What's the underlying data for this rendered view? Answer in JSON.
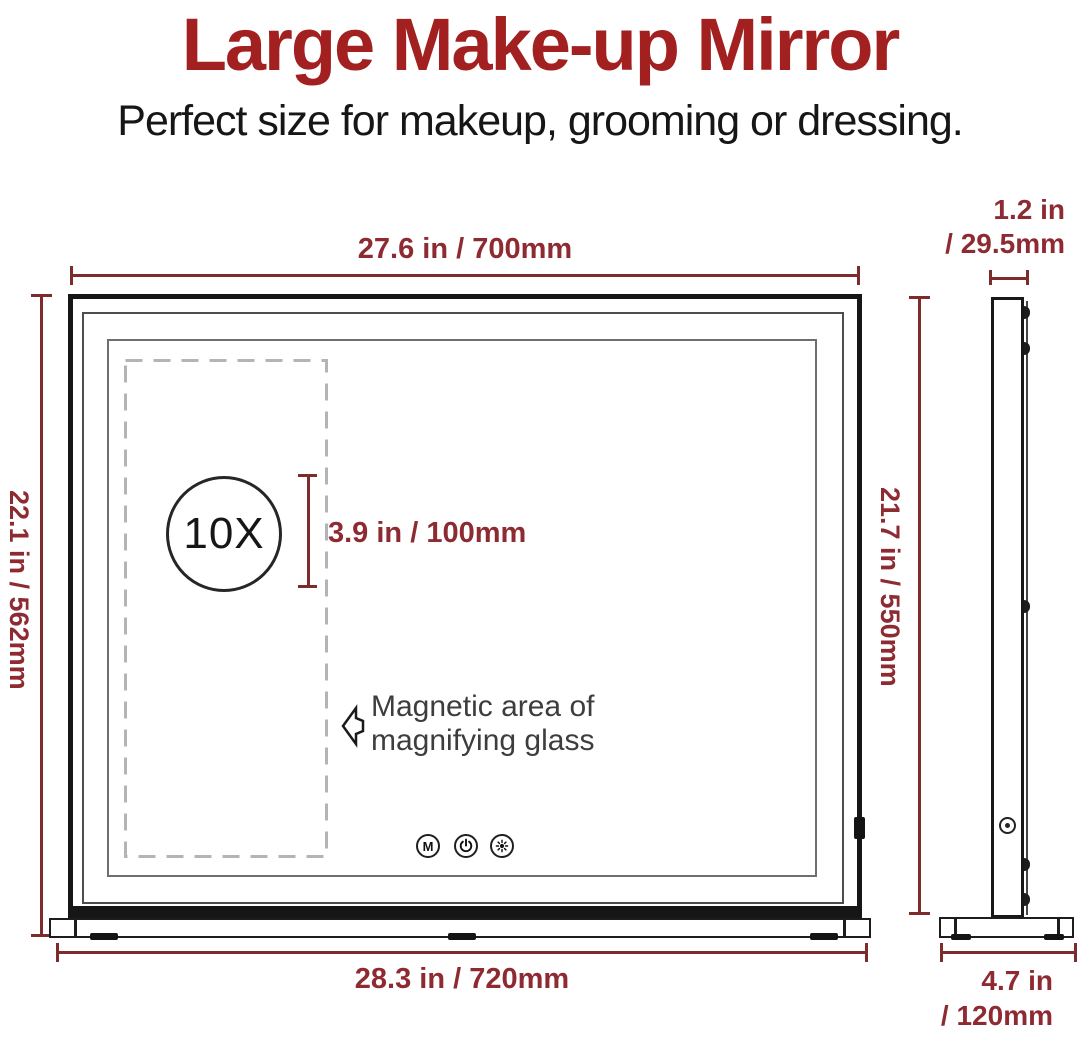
{
  "page": {
    "title": "Large Make-up Mirror",
    "subtitle": "Perfect size for makeup, grooming or dressing."
  },
  "front_view": {
    "width_dimension": "27.6 in / 700mm",
    "height_dimension": "22.1 in / 562mm",
    "base_width_dimension": "28.3 in / 720mm",
    "magnifier": {
      "zoom_label": "10X",
      "area_height_dimension": "3.9 in / 100mm",
      "note_line1": "Magnetic area of",
      "note_line2": "magnifying glass"
    },
    "control_buttons": [
      {
        "name": "mode-button",
        "glyph": "M"
      },
      {
        "name": "power-button",
        "icon": "power-icon"
      },
      {
        "name": "brightness-button",
        "icon": "brightness-icon"
      }
    ]
  },
  "side_view": {
    "depth_dimension_line1": "1.2 in",
    "depth_dimension_line2": "/ 29.5mm",
    "height_dimension": "21.7 in / 550mm",
    "base_depth_dimension_line1": "4.7 in",
    "base_depth_dimension_line2": "/ 120mm"
  },
  "colors": {
    "title_red": "#a32020",
    "dim_red": "#8e2b32",
    "line_red": "#7e2b2b"
  }
}
